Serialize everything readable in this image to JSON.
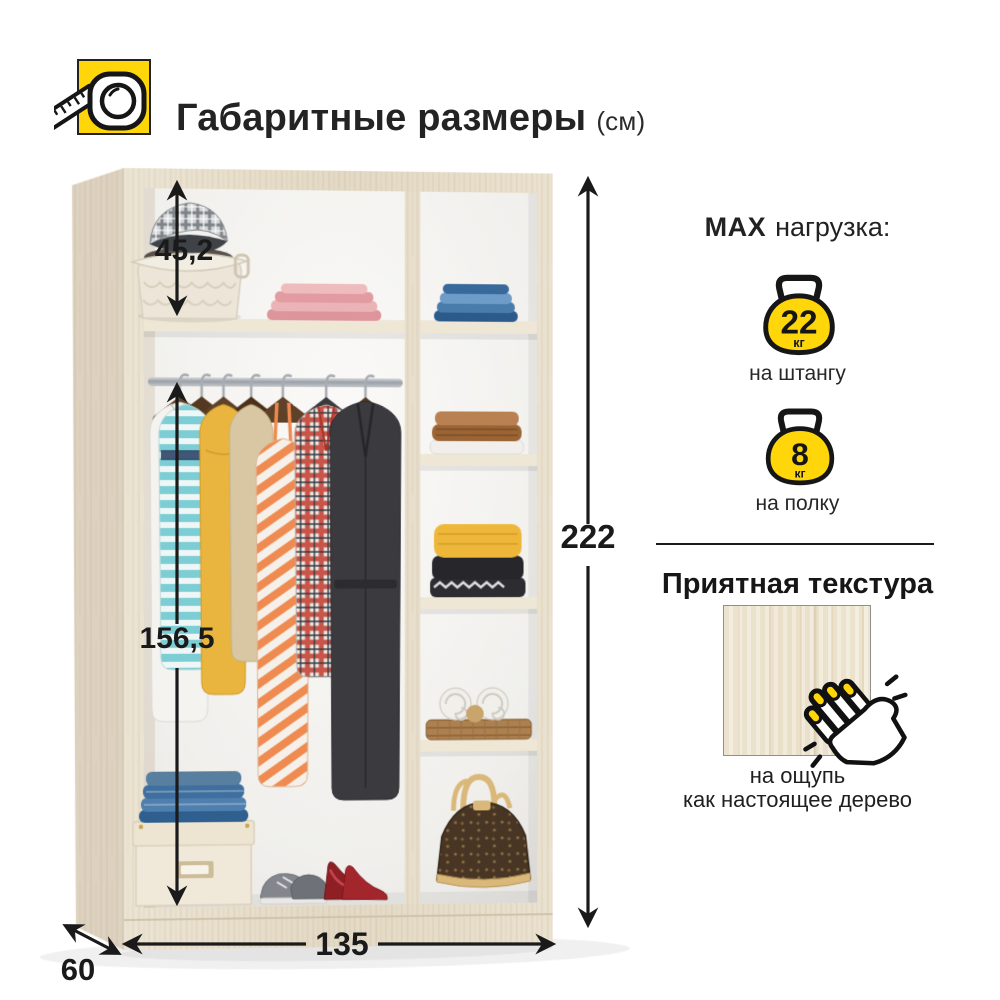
{
  "header": {
    "title": "Габаритные размеры",
    "unit": "(см)"
  },
  "dimensions": {
    "top_section_height": "45,2",
    "hanging_height": "156,5",
    "total_height": "222",
    "width": "135",
    "depth": "60"
  },
  "max_load": {
    "prefix": "MAX",
    "suffix": "нагрузка:",
    "items": [
      {
        "value": "22",
        "unit": "кг",
        "label": "на штангу"
      },
      {
        "value": "8",
        "unit": "кг",
        "label": "на полку"
      }
    ]
  },
  "texture": {
    "heading": "Приятная текстура",
    "caption_line1": "на ощупь",
    "caption_line2": "как настоящее дерево"
  },
  "icons": {
    "header_icon": "measuring-tape-icon",
    "load_icon": "kettlebell-icon",
    "texture_icon": "knocking-hand-icon"
  },
  "colors": {
    "accent_yellow": "#FFD60A",
    "ink": "#1A1A1A",
    "wood_light": "#EAE2D0",
    "wood_side": "#DDD2BF",
    "interior_white": "#F4F3F0"
  }
}
